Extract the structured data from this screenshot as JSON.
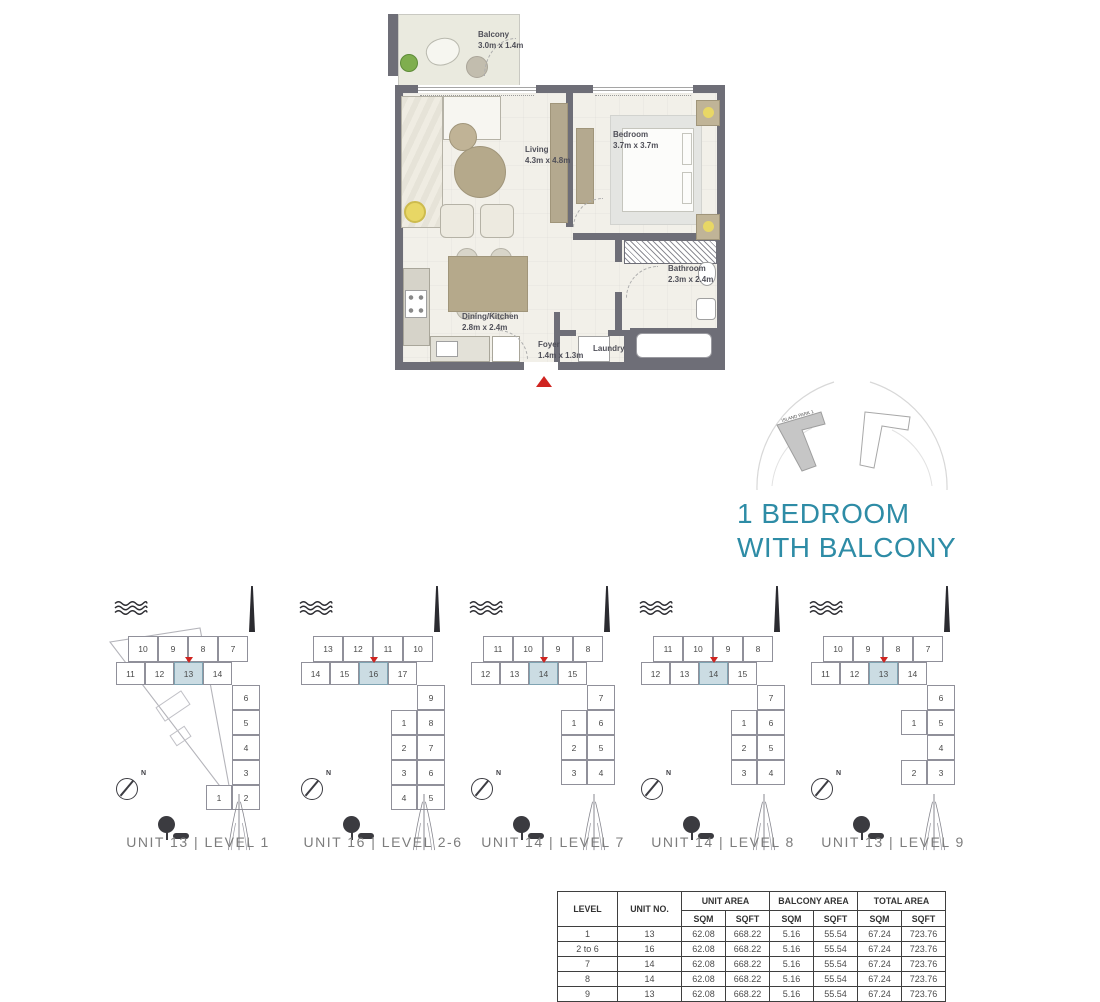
{
  "title": {
    "line1": "1 BEDROOM",
    "line2": "WITH BALCONY"
  },
  "colors": {
    "accent_teal": "#2e8ca6",
    "highlight_fill": "#cbdce3",
    "marker_red": "#cf2420",
    "wall": "#6e6e77"
  },
  "icons": {
    "waves": "water-waves-icon",
    "spire": "spire-landmark-icon",
    "tower": "creek-tower-icon",
    "compass": "compass-north-icon",
    "tree": "tree-icon",
    "entry": "entry-arrow-icon"
  },
  "floorplan": {
    "rooms": [
      {
        "name": "Balcony",
        "dims": "3.0m x 1.4m"
      },
      {
        "name": "Living",
        "dims": "4.3m x 4.8m"
      },
      {
        "name": "Bedroom",
        "dims": "3.7m x 3.7m"
      },
      {
        "name": "Bathroom",
        "dims": "2.3m x 2.4m"
      },
      {
        "name": "Dining/Kitchen",
        "dims": "2.8m x 2.4m"
      },
      {
        "name": "Foyer",
        "dims": "1.4m x 1.3m"
      },
      {
        "name": "Laundry",
        "dims": ""
      }
    ]
  },
  "locator": {
    "building_label": "ISLAND PARK 1"
  },
  "diagrams": [
    {
      "label": "UNIT 13 | LEVEL 1",
      "top_row": [
        "10",
        "9",
        "8",
        "7"
      ],
      "mid_row": [
        "11",
        "12",
        "13",
        "14"
      ],
      "highlight_index": 2,
      "arm_rows": [
        [
          null,
          "6"
        ],
        [
          null,
          "5"
        ],
        [
          null,
          "4"
        ],
        [
          null,
          "3"
        ],
        [
          "1",
          "2"
        ]
      ],
      "compass_label": "N",
      "plot_outline": true
    },
    {
      "label": "UNIT 16 | LEVEL 2-6",
      "top_row": [
        "13",
        "12",
        "11",
        "10"
      ],
      "mid_row": [
        "14",
        "15",
        "16",
        "17"
      ],
      "highlight_index": 2,
      "arm_rows": [
        [
          null,
          "9"
        ],
        [
          "1",
          "8"
        ],
        [
          "2",
          "7"
        ],
        [
          "3",
          "6"
        ],
        [
          "4",
          "5"
        ]
      ],
      "compass_label": "N",
      "plot_outline": false
    },
    {
      "label": "UNIT 14 | LEVEL 7",
      "top_row": [
        "11",
        "10",
        "9",
        "8"
      ],
      "mid_row": [
        "12",
        "13",
        "14",
        "15"
      ],
      "highlight_index": 2,
      "arm_rows": [
        [
          null,
          "7"
        ],
        [
          "1",
          "6"
        ],
        [
          "2",
          "5"
        ],
        [
          "3",
          "4"
        ]
      ],
      "compass_label": "N",
      "plot_outline": false
    },
    {
      "label": "UNIT 14 | LEVEL 8",
      "top_row": [
        "11",
        "10",
        "9",
        "8"
      ],
      "mid_row": [
        "12",
        "13",
        "14",
        "15"
      ],
      "highlight_index": 2,
      "arm_rows": [
        [
          null,
          "7"
        ],
        [
          "1",
          "6"
        ],
        [
          "2",
          "5"
        ],
        [
          "3",
          "4"
        ]
      ],
      "compass_label": "N",
      "plot_outline": false
    },
    {
      "label": "UNIT 13 | LEVEL 9",
      "top_row": [
        "10",
        "9",
        "8",
        "7"
      ],
      "mid_row": [
        "11",
        "12",
        "13",
        "14"
      ],
      "highlight_index": 2,
      "arm_rows": [
        [
          null,
          "6"
        ],
        [
          "1",
          "5"
        ],
        [
          null,
          "4"
        ],
        [
          "2",
          "3"
        ]
      ],
      "compass_label": "N",
      "plot_outline": false
    }
  ],
  "table": {
    "headers": {
      "level": "LEVEL",
      "unit_no": "UNIT NO.",
      "sqm": "SQM",
      "sqft": "SQFT"
    },
    "col_groups": [
      {
        "label": "UNIT AREA"
      },
      {
        "label": "BALCONY AREA"
      },
      {
        "label": "TOTAL AREA"
      }
    ],
    "rows": [
      [
        "1",
        "13",
        "62.08",
        "668.22",
        "5.16",
        "55.54",
        "67.24",
        "723.76"
      ],
      [
        "2 to 6",
        "16",
        "62.08",
        "668.22",
        "5.16",
        "55.54",
        "67.24",
        "723.76"
      ],
      [
        "7",
        "14",
        "62.08",
        "668.22",
        "5.16",
        "55.54",
        "67.24",
        "723.76"
      ],
      [
        "8",
        "14",
        "62.08",
        "668.22",
        "5.16",
        "55.54",
        "67.24",
        "723.76"
      ],
      [
        "9",
        "13",
        "62.08",
        "668.22",
        "5.16",
        "55.54",
        "67.24",
        "723.76"
      ]
    ]
  }
}
